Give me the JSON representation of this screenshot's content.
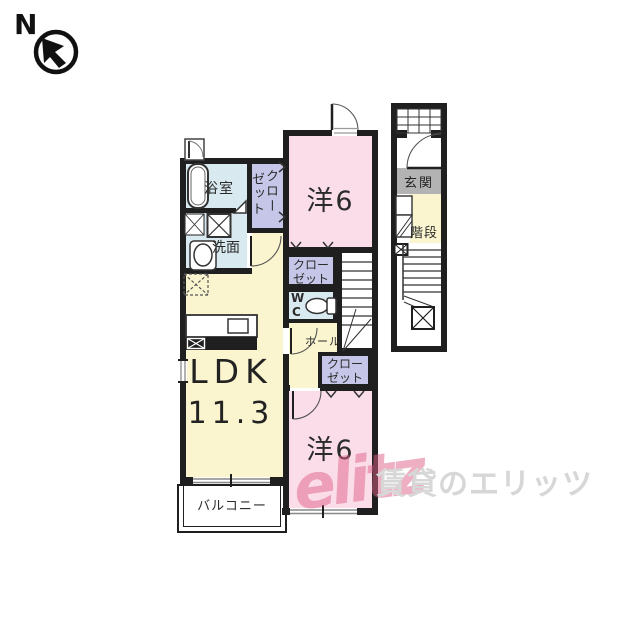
{
  "compass": {
    "label": "N"
  },
  "rooms": {
    "bathroom": {
      "label": "浴室"
    },
    "washroom": {
      "label": "洗面"
    },
    "closet_left": {
      "label": "クローゼット",
      "col1": "クロー",
      "col2": "ゼット"
    },
    "western_top": {
      "label": "洋6"
    },
    "closet_mid": {
      "line1": "クロー",
      "line2": "ゼット"
    },
    "wc": {
      "line1": "W",
      "line2": "C"
    },
    "hall": {
      "label": "ホール"
    },
    "closet_bottom": {
      "line1": "クロー",
      "line2": "ゼット"
    },
    "ldk": {
      "label": "LDK",
      "area": "11.3"
    },
    "western_bottom": {
      "label": "洋6"
    },
    "balcony": {
      "label": "バルコニー"
    },
    "entrance": {
      "label": "玄関"
    },
    "staircase": {
      "label": "階段"
    }
  },
  "watermark": {
    "logo": "elitz",
    "text": "賃貸のエリッツ"
  },
  "colors": {
    "room_pink": "#fadde8",
    "room_yellow": "#faf5cf",
    "room_blue": "#d9e9f0",
    "closet_lavender": "#c6c7e8",
    "entrance_gray": "#b3b3b3",
    "wall": "#1f1f1f",
    "watermark_gray": "#d7d7d7",
    "watermark_pink": "#e05f87"
  }
}
